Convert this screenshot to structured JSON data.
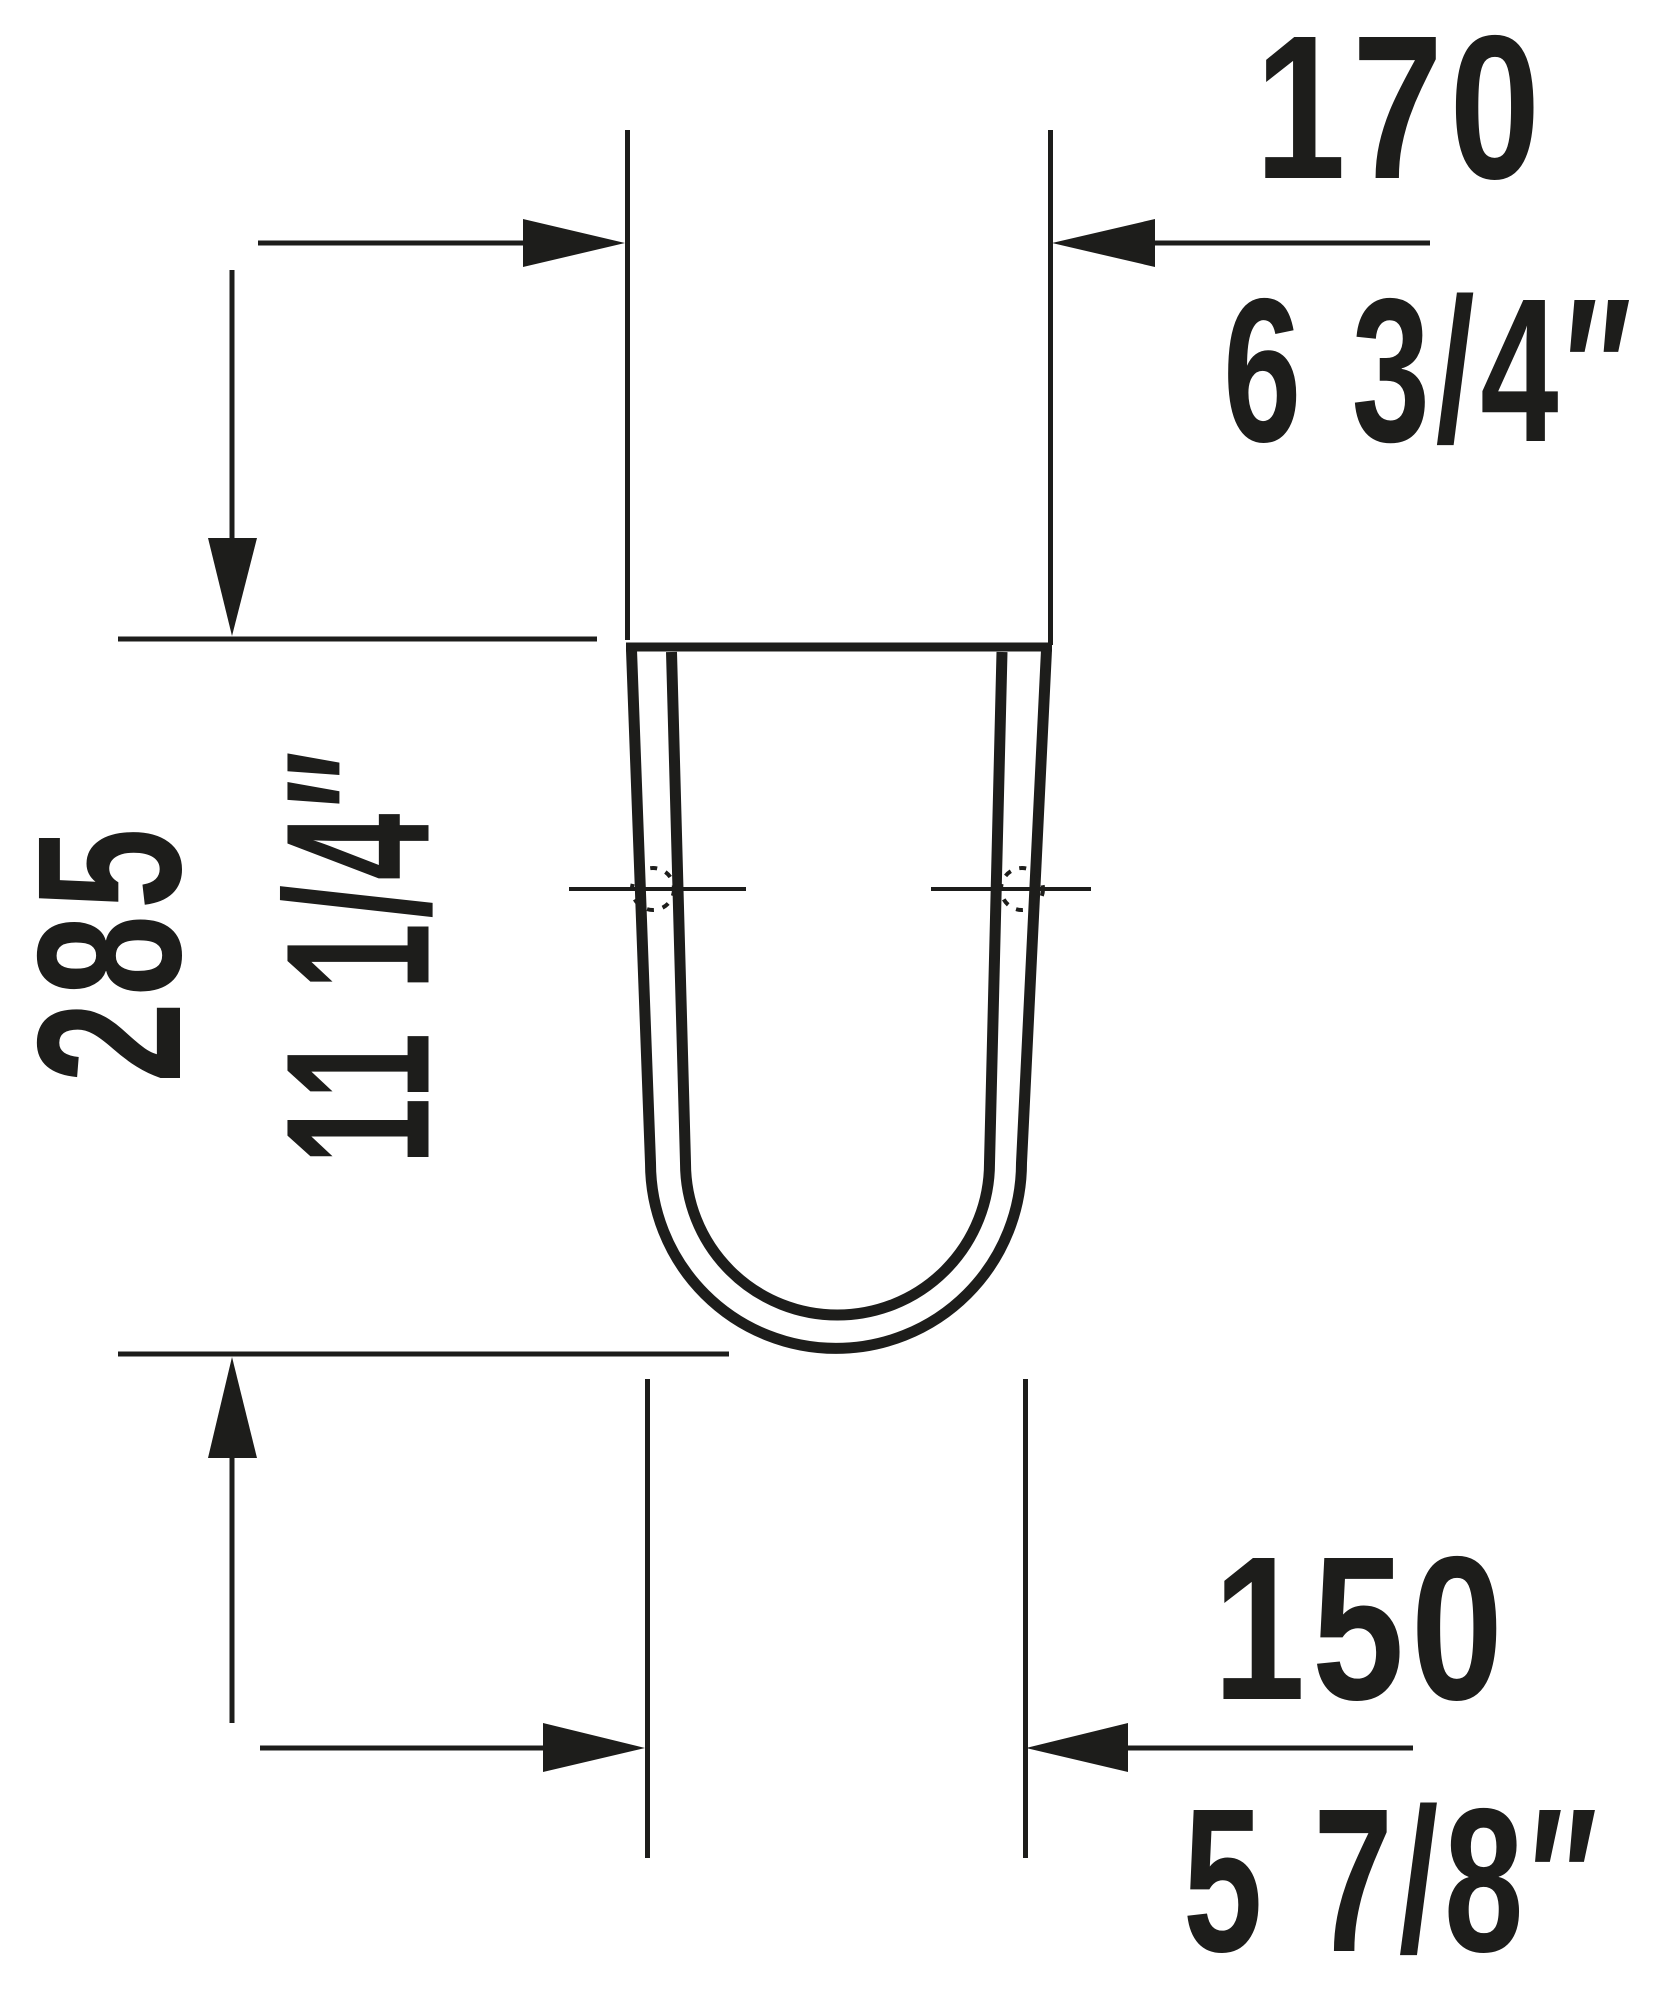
{
  "drawing": {
    "type": "technical-dimension-drawing",
    "object": "u-shaped-siphon-cover-front-view",
    "background_color": "#ffffff",
    "line_color": "#1d1d1b",
    "dimensions": {
      "top_width": {
        "mm": "170",
        "inch": "6 3/4″"
      },
      "height": {
        "mm": "285",
        "inch": "11 1/4″"
      },
      "bottom_width": {
        "mm": "150",
        "inch": "5 7/8″"
      }
    }
  }
}
